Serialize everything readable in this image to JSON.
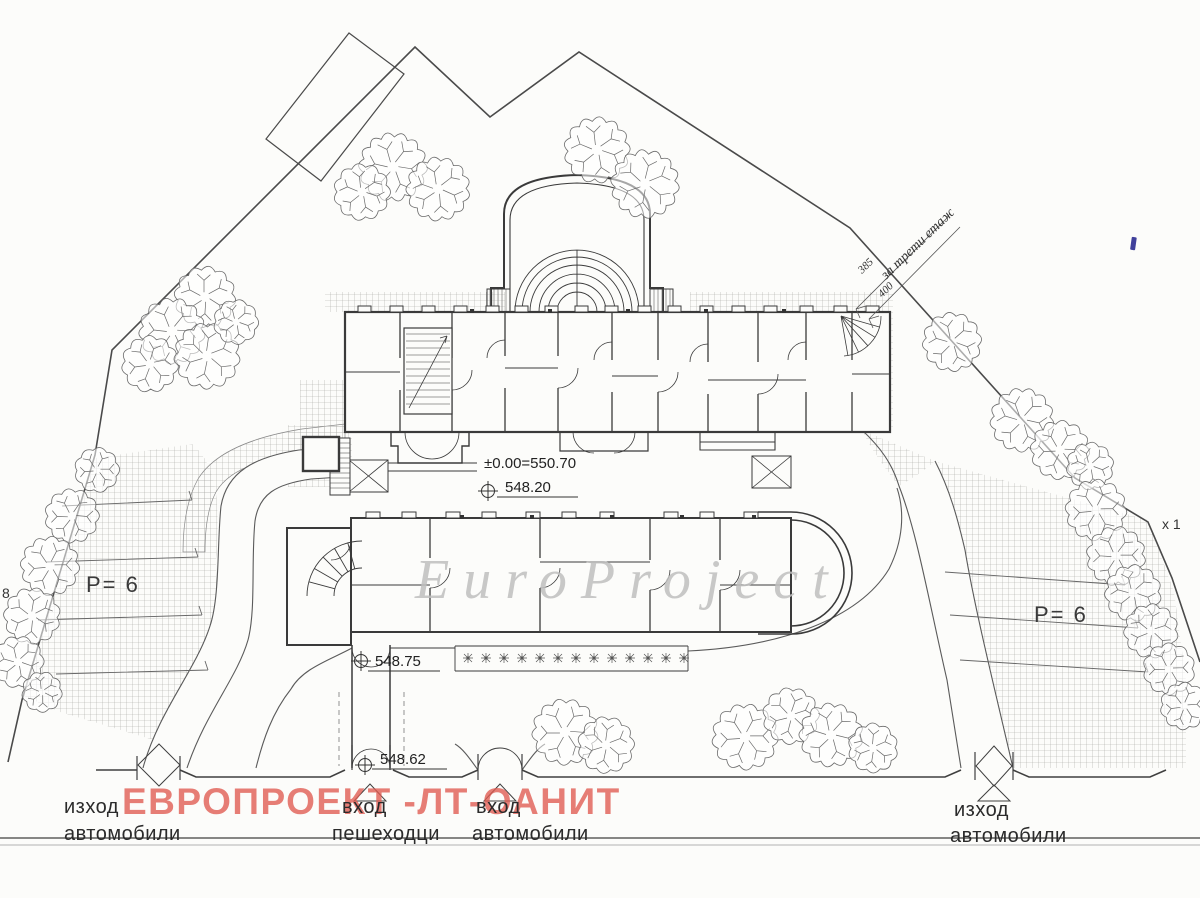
{
  "drawing": {
    "watermark_en": "EuroProject",
    "watermark_red": "ЕВРОПРОЕКТ -ЛТ-ОАНИТ",
    "elevations": {
      "datum": "±0.00=550.70",
      "forecourt": "548.20",
      "entry_landing": "548.75",
      "gate_landing": "548.62"
    },
    "parking": {
      "left_label": "P= 6",
      "right_label": "P= 6"
    },
    "entrances": {
      "exit_left": {
        "line1": "изход",
        "line2": "автомобили"
      },
      "pedestrian": {
        "line1": "вход",
        "line2": "пешеходци"
      },
      "vehicle_entry": {
        "line1": "вход",
        "line2": "автомобили"
      },
      "exit_right": {
        "line1": "изход",
        "line2": "автомобили"
      }
    },
    "annotations": {
      "third_floor_note": "за трети етаж",
      "dim_385": "385",
      "dim_400": "400",
      "left_edge_mark": "8",
      "right_edge_mark": "х 1"
    },
    "colors": {
      "ink": "#3a3a3a",
      "hatch": "#a8a8a4",
      "watermark_red": "#e05a50",
      "watermark_gray": "#bfbfbf"
    }
  }
}
